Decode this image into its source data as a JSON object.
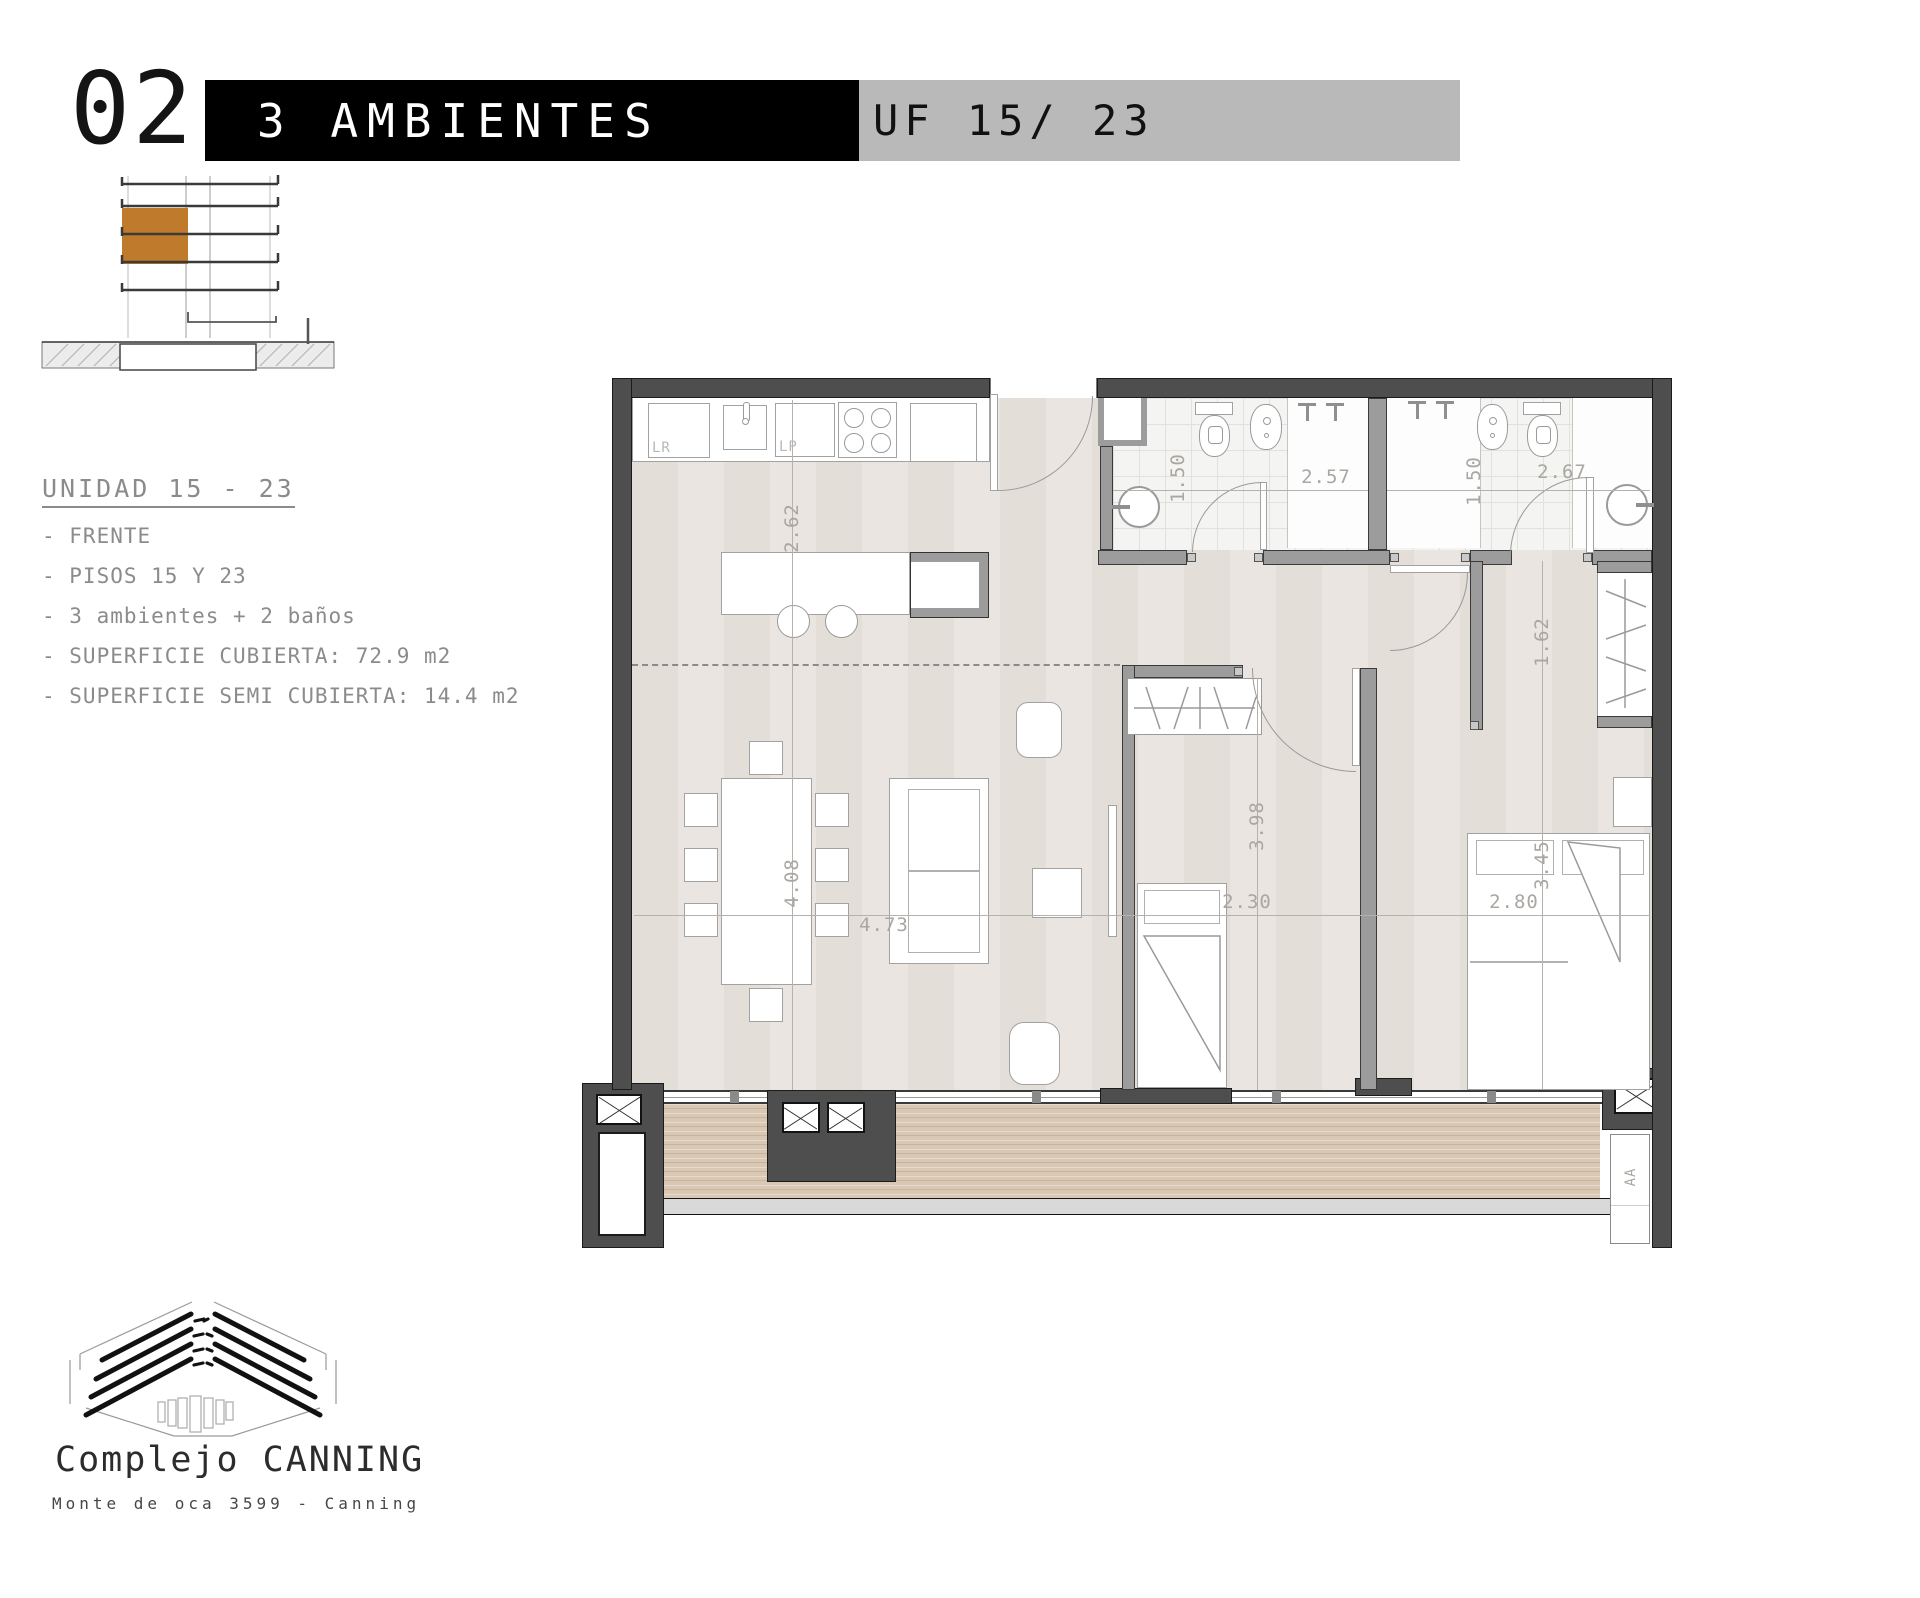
{
  "header": {
    "index": "02.",
    "category": "3 AMBIENTES",
    "unit": "UF 15/ 23"
  },
  "info": {
    "title": "UNIDAD 15 - 23",
    "lines": [
      "- FRENTE",
      "- PISOS 15 Y 23",
      "- 3 ambientes + 2 baños",
      "- SUPERFICIE CUBIERTA: 72.9 m2",
      "- SUPERFICIE SEMI CUBIERTA: 14.4 m2"
    ]
  },
  "plan": {
    "labels": {
      "washer": "LR",
      "dishwasher": "LP",
      "ac": "AA"
    },
    "dims": {
      "kitchen_depth": "2.62",
      "living_length": "4.08",
      "living_width": "4.73",
      "bath1_depth": "1.50",
      "bath1_width": "2.57",
      "bath2_depth": "1.50",
      "bath2_width": "2.67",
      "dressing_depth": "1.62",
      "bedroom1_length": "3.45",
      "bedroom1_width": "2.80",
      "bedroom2_length": "3.98",
      "bedroom2_width": "2.30"
    }
  },
  "footer": {
    "brand": "Complejo CANNING",
    "address": "Monte de oca 3599 - Canning"
  },
  "colors": {
    "accent": "#c07a2c",
    "wall": "#4e4e4e",
    "bar_black": "#000000",
    "bar_gray": "#b9b9b9"
  }
}
